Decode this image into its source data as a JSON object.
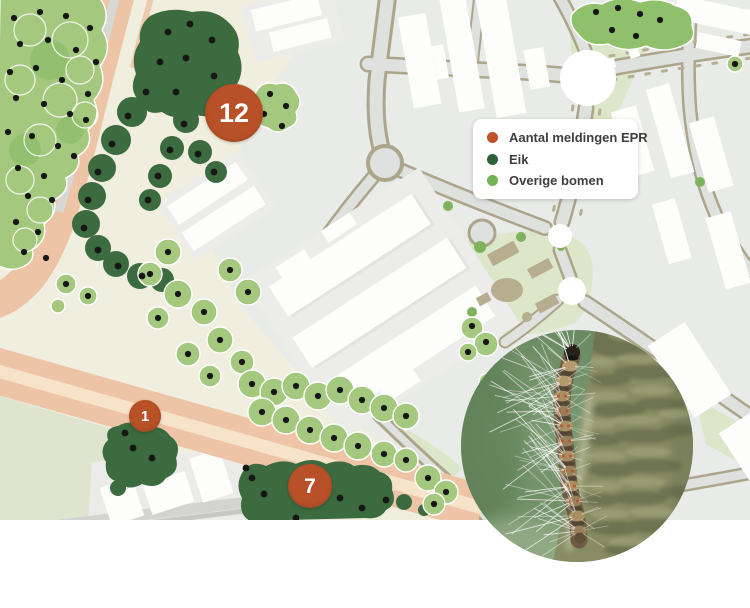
{
  "legend": {
    "items": [
      {
        "label": "Aantal meldingen EPR",
        "color": "#c0522c"
      },
      {
        "label": "Eik",
        "color": "#2f6038"
      },
      {
        "label": "Overige bomen",
        "color": "#77b254"
      }
    ]
  },
  "marker_color": "#b85127",
  "markers": [
    {
      "value": "12",
      "x": 234,
      "y": 113,
      "d": 58
    },
    {
      "value": "1",
      "x": 145,
      "y": 416,
      "d": 32
    },
    {
      "value": "7",
      "x": 310,
      "y": 486,
      "d": 44
    }
  ],
  "map": {
    "colors": {
      "oak": "#3c6b40",
      "tree": "#a3c87e",
      "dot": "#161616"
    },
    "tree_dots": [
      [
        14,
        18
      ],
      [
        40,
        12
      ],
      [
        66,
        16
      ],
      [
        90,
        28
      ],
      [
        20,
        44
      ],
      [
        48,
        40
      ],
      [
        76,
        50
      ],
      [
        96,
        62
      ],
      [
        10,
        72
      ],
      [
        36,
        68
      ],
      [
        62,
        80
      ],
      [
        88,
        94
      ],
      [
        16,
        98
      ],
      [
        44,
        104
      ],
      [
        70,
        114
      ],
      [
        86,
        120
      ],
      [
        8,
        132
      ],
      [
        32,
        136
      ],
      [
        58,
        146
      ],
      [
        74,
        156
      ],
      [
        18,
        168
      ],
      [
        44,
        176
      ],
      [
        28,
        196
      ],
      [
        52,
        200
      ],
      [
        16,
        222
      ],
      [
        38,
        232
      ],
      [
        24,
        252
      ],
      [
        46,
        258
      ],
      [
        66,
        284
      ],
      [
        88,
        296
      ],
      [
        270,
        94
      ],
      [
        286,
        106
      ],
      [
        264,
        114
      ],
      [
        282,
        126
      ],
      [
        596,
        12
      ],
      [
        618,
        8
      ],
      [
        640,
        14
      ],
      [
        660,
        20
      ],
      [
        612,
        30
      ],
      [
        636,
        36
      ],
      [
        168,
        252
      ],
      [
        150,
        274
      ],
      [
        178,
        294
      ],
      [
        204,
        312
      ],
      [
        158,
        318
      ],
      [
        230,
        270
      ],
      [
        248,
        292
      ],
      [
        220,
        340
      ],
      [
        188,
        354
      ],
      [
        242,
        362
      ],
      [
        210,
        376
      ],
      [
        252,
        384
      ],
      [
        274,
        392
      ],
      [
        296,
        386
      ],
      [
        318,
        396
      ],
      [
        340,
        390
      ],
      [
        362,
        400
      ],
      [
        384,
        408
      ],
      [
        406,
        416
      ],
      [
        262,
        412
      ],
      [
        286,
        420
      ],
      [
        310,
        430
      ],
      [
        334,
        438
      ],
      [
        358,
        446
      ],
      [
        384,
        454
      ],
      [
        406,
        460
      ],
      [
        472,
        326
      ],
      [
        486,
        342
      ],
      [
        468,
        352
      ],
      [
        428,
        478
      ],
      [
        446,
        492
      ],
      [
        434,
        504
      ],
      [
        488,
        382
      ],
      [
        735,
        64
      ]
    ],
    "oak_dots": [
      [
        168,
        32
      ],
      [
        190,
        24
      ],
      [
        212,
        40
      ],
      [
        160,
        62
      ],
      [
        186,
        58
      ],
      [
        214,
        76
      ],
      [
        176,
        92
      ],
      [
        146,
        92
      ],
      [
        128,
        116
      ],
      [
        112,
        144
      ],
      [
        98,
        172
      ],
      [
        88,
        200
      ],
      [
        84,
        228
      ],
      [
        98,
        250
      ],
      [
        118,
        266
      ],
      [
        142,
        276
      ],
      [
        184,
        124
      ],
      [
        170,
        150
      ],
      [
        158,
        176
      ],
      [
        148,
        200
      ],
      [
        198,
        154
      ],
      [
        214,
        172
      ],
      [
        125,
        433
      ],
      [
        133,
        448
      ],
      [
        152,
        458
      ],
      [
        246,
        468
      ],
      [
        252,
        478
      ],
      [
        264,
        494
      ],
      [
        340,
        498
      ],
      [
        362,
        508
      ],
      [
        386,
        500
      ],
      [
        296,
        518
      ]
    ]
  },
  "photo": {
    "subject": "eikenprocessierups close-up on branch"
  }
}
